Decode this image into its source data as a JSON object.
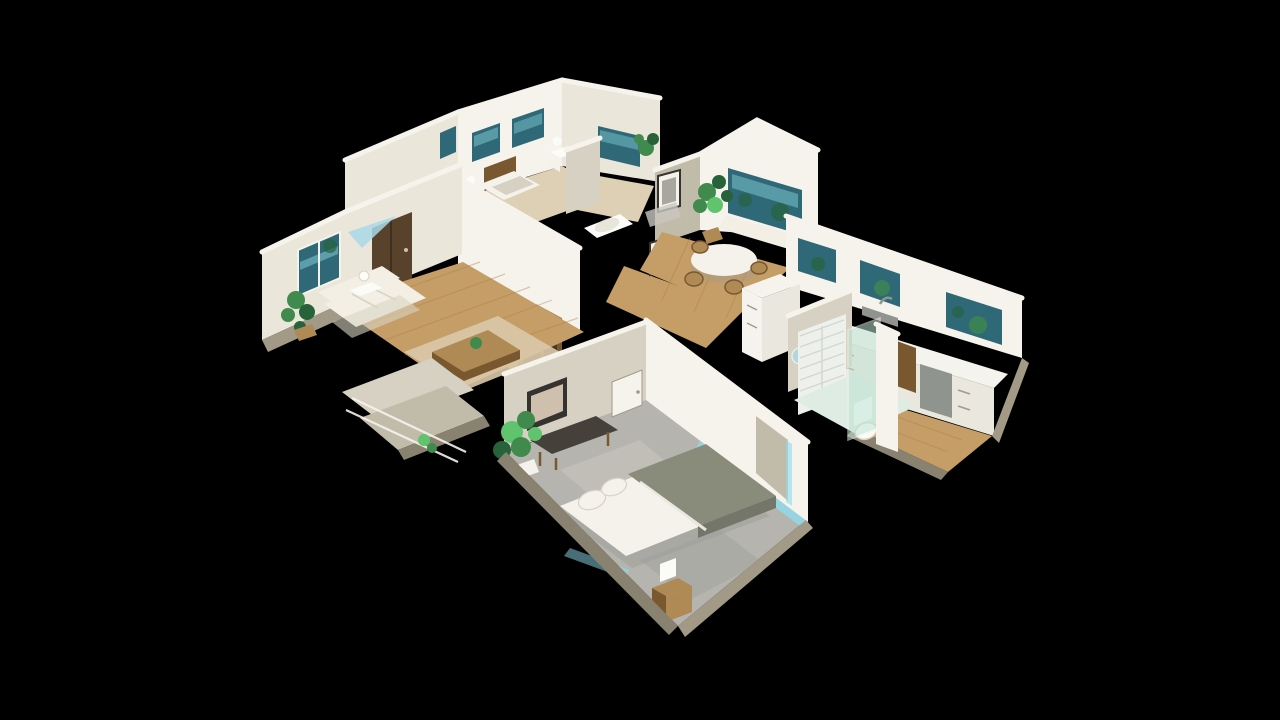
{
  "canvas": {
    "width": 1280,
    "height": 720,
    "background": "#000000"
  },
  "scene": {
    "name": "dollhouse-3d-view",
    "description": "Cutaway 3D dollhouse view of a furnished single-story home seen from above at an angle, floating on a black background",
    "projection": "isometric-birdseye"
  },
  "colors": {
    "bg": "#000000",
    "wall_bright": "#f6f3ec",
    "wall_light": "#eae6da",
    "wall_mid": "#d6d1c2",
    "wall_dim": "#c1bbaa",
    "wall_shadow": "#a29a86",
    "band_shadow": "#8a8270",
    "floor_wood": "#c59d67",
    "floor_wood_light": "#d8b584",
    "floor_wood_dark": "#a98049",
    "floor_pale": "#ddd0b4",
    "carpet": "#b6b4ae",
    "carpet_light": "#c9c7c0",
    "carpet_shadow": "#9c9d99",
    "window_teal": "#2f6876",
    "window_teal_light": "#7cc3cf",
    "window_blue": "#a8d8e8",
    "foliage": "#3f8a4c",
    "foliage_dark": "#27623a",
    "foliage_bright": "#5fc46d",
    "door_brown": "#58422c",
    "door_brown_dark": "#3f2f1e",
    "sofa_white": "#f3efe5",
    "sofa_shadow": "#d9d3c3",
    "duvet_sage": "#8a8c7b",
    "duvet_sage_dark": "#74766a",
    "sheet_white": "#f4f2eb",
    "bench_dark": "#45403a",
    "wood_mid": "#b08a55",
    "wood_dark": "#7a582f",
    "counter_white": "#f5f3ed",
    "cabinet_white": "#eae7de",
    "steel": "#8f948f",
    "tile": "#eef0ec",
    "tile_line": "#d2d7d1",
    "glass_mint": "#bfe4d4",
    "glow_cyan": "#8fdcee",
    "toilet_white": "#fbfbf8",
    "frame_dark": "#34332f",
    "art_beige": "#cfc0ae",
    "art_gray": "#a9a6a0",
    "rug": "#d9c9aa"
  },
  "rooms": [
    {
      "id": "living-room",
      "floor": "hardwood",
      "items": [
        "white-sofa",
        "area-rug",
        "coffee-table",
        "side-table-lamp",
        "media-cabinet",
        "wall-art",
        "potted-plant"
      ]
    },
    {
      "id": "entry",
      "items": [
        "brown-front-door",
        "blue-transom-light"
      ]
    },
    {
      "id": "back-bedroom-west",
      "floor": "pale-wood",
      "items": [
        "bed-brown-headboard",
        "table-lamp",
        "two-windows"
      ]
    },
    {
      "id": "back-bedroom-north",
      "floor": "pale-wood",
      "items": [
        "side-table",
        "table-lamp",
        "window",
        "potted-plant"
      ]
    },
    {
      "id": "hall-bathroom",
      "items": [
        "bathtub",
        "partition-walls"
      ]
    },
    {
      "id": "hallway",
      "floor": "hardwood",
      "items": [
        "framed-art",
        "framed-art-2",
        "glass-rail"
      ]
    },
    {
      "id": "dining-nook",
      "floor": "hardwood",
      "items": [
        "round-table",
        "wicker-chairs",
        "window-seat",
        "picture-window",
        "tall-plant"
      ]
    },
    {
      "id": "kitchen",
      "floor": "hardwood",
      "items": [
        "counter",
        "white-cabinets",
        "window-row",
        "sink-faucet",
        "refrigerator-cabinet",
        "appliance",
        "dark-cabinet"
      ]
    },
    {
      "id": "master-bedroom",
      "floor": "carpet",
      "items": [
        "bed-sage-duvet",
        "pillows",
        "black-bench",
        "nightstand",
        "lamp",
        "monstera-plant",
        "wall-art",
        "white-door",
        "led-glow-strip"
      ]
    },
    {
      "id": "master-bathroom",
      "items": [
        "subway-tile-shower",
        "mint-glass-panel",
        "toilet",
        "round-mirror"
      ]
    },
    {
      "id": "deck",
      "items": [
        "steps",
        "white-railing",
        "small-plant"
      ]
    }
  ]
}
